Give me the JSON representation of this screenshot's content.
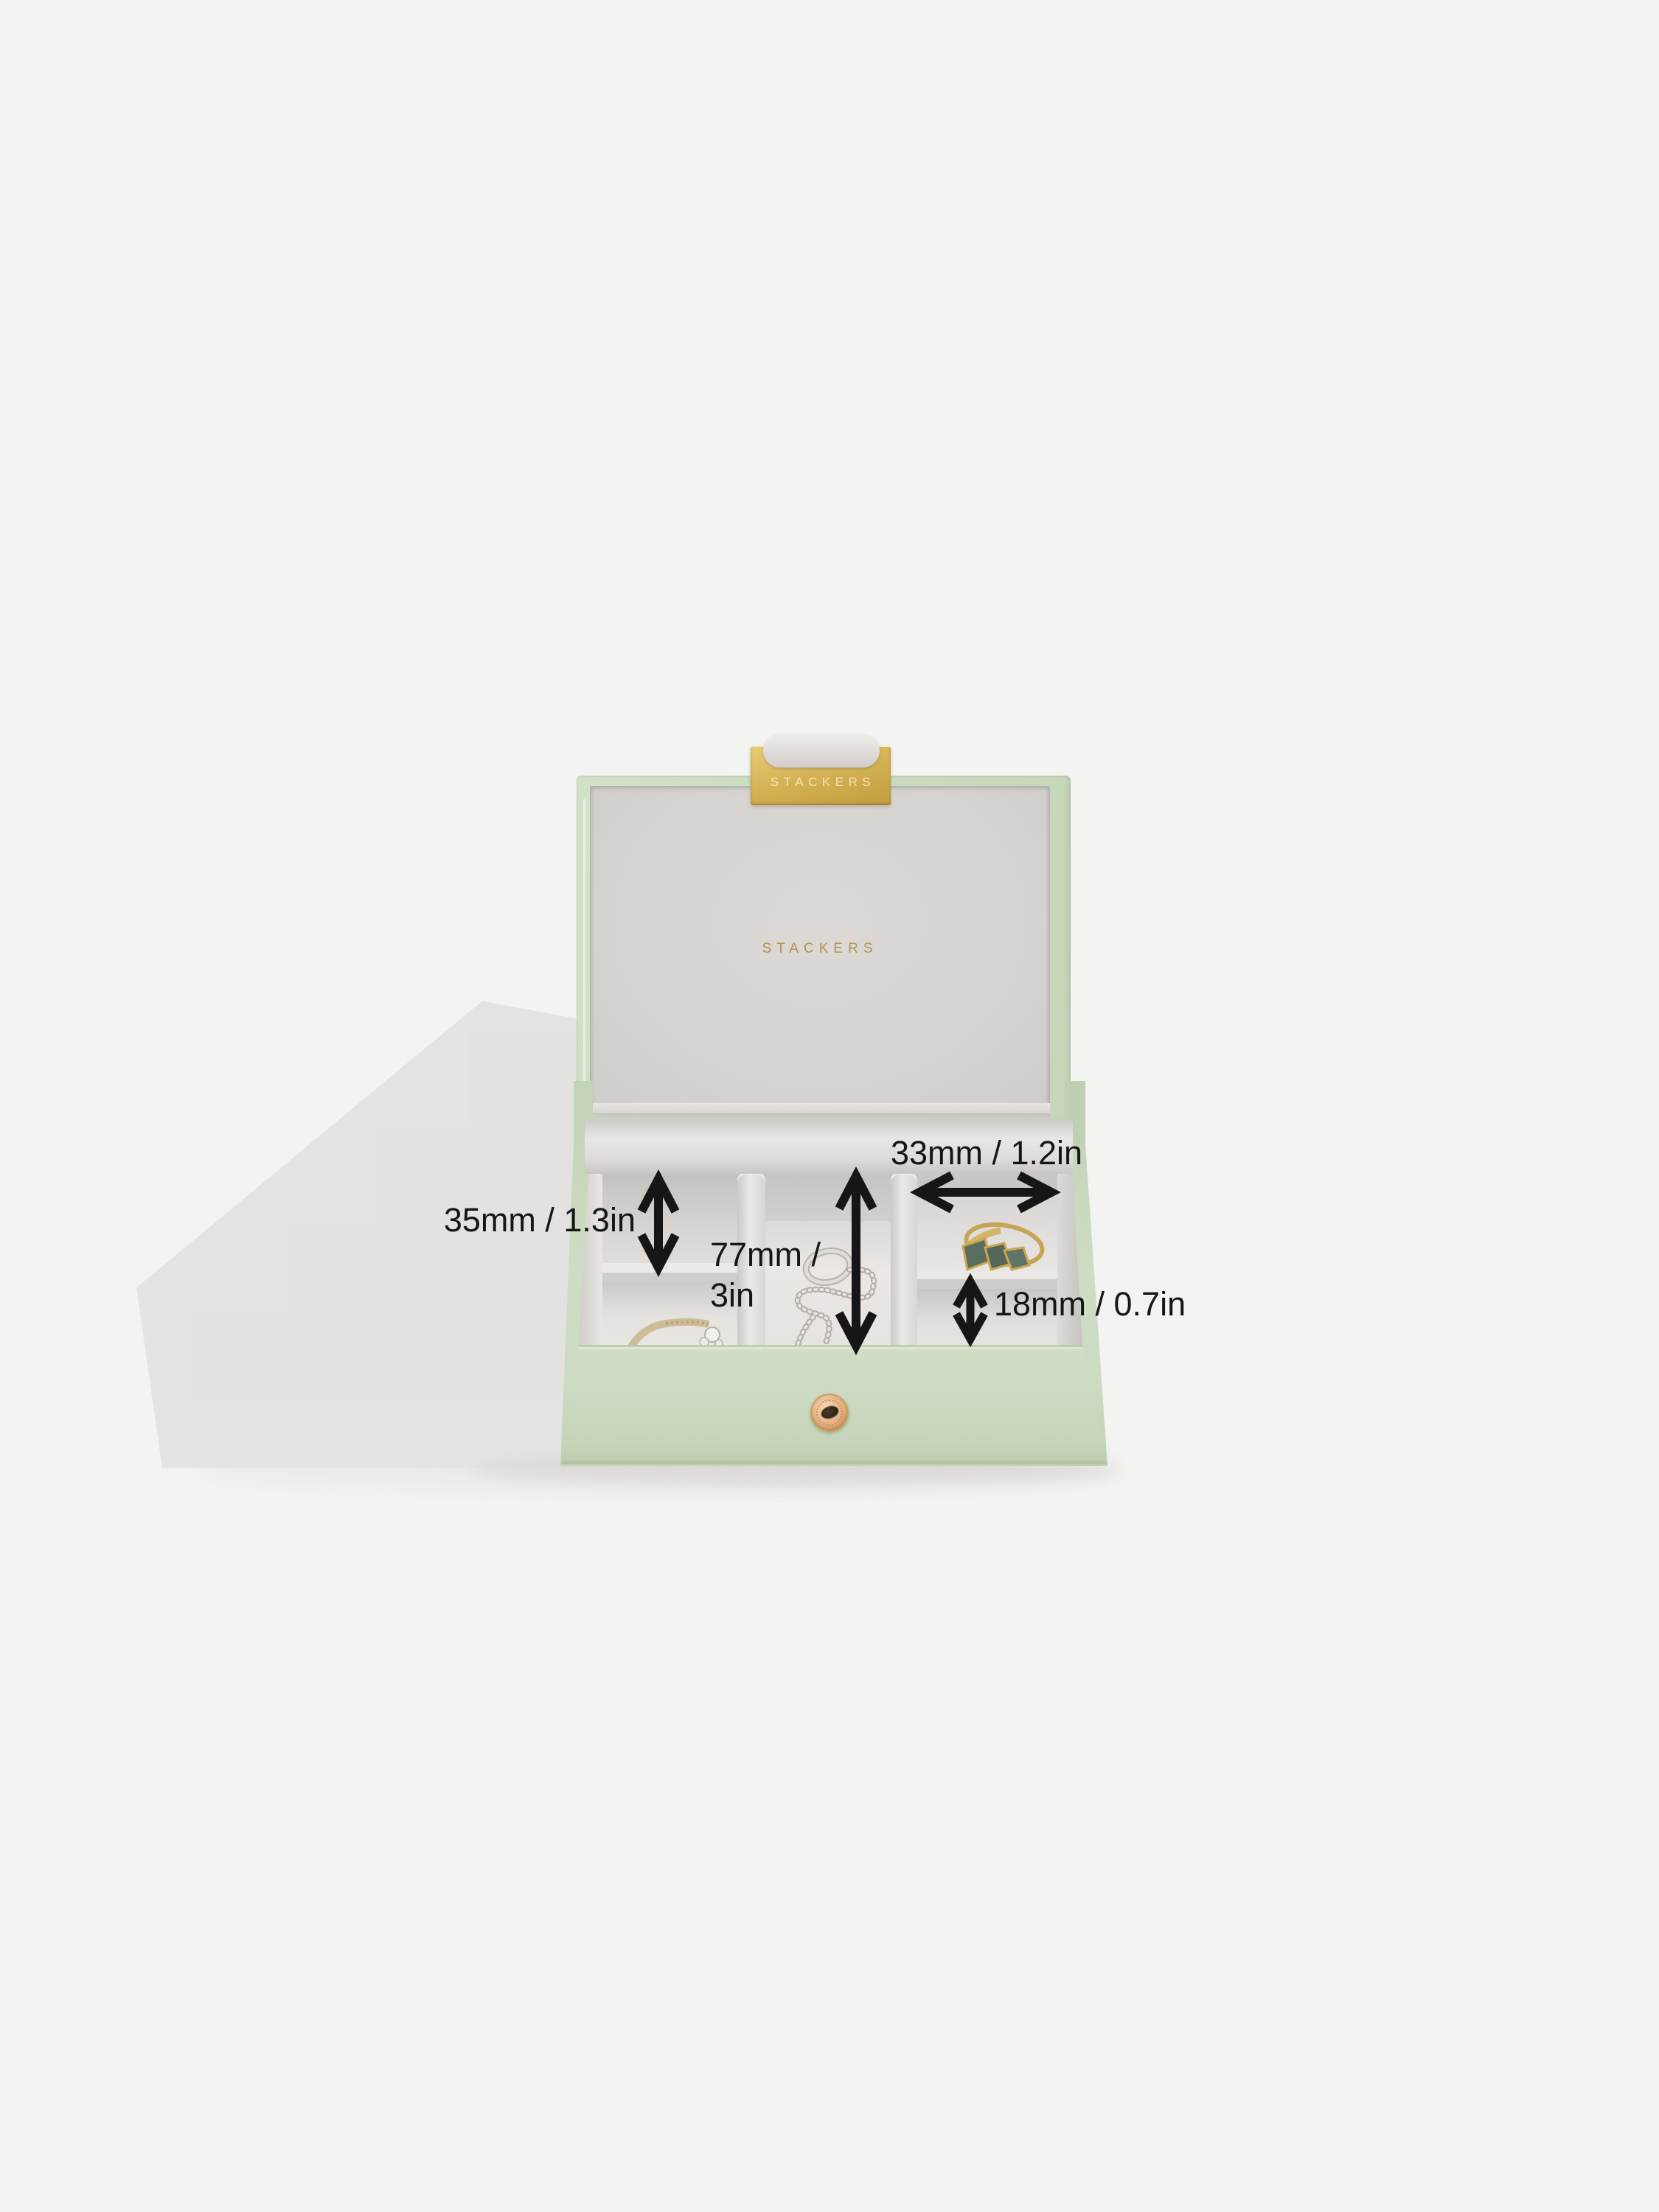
{
  "brand": {
    "clasp_label": "STACKERS",
    "lid_label": "STACKERS"
  },
  "dimension_labels": {
    "compartment_depth": "35mm / 1.3in",
    "compartment_length_line1": "77mm /",
    "compartment_length_line2": "3in",
    "compartment_width": "33mm / 1.2in",
    "small_compartment_depth": "18mm / 0.7in"
  },
  "colors": {
    "background": "#f3f3f1",
    "leather_sage_green": "#cbdac0",
    "velvet_grey": "#d8d5d2",
    "gold_clasp": "#d6b456",
    "gold_lettering": "#b2924b",
    "rose_gold_stud": "#ebbc8e",
    "annotation_black": "#161616"
  }
}
